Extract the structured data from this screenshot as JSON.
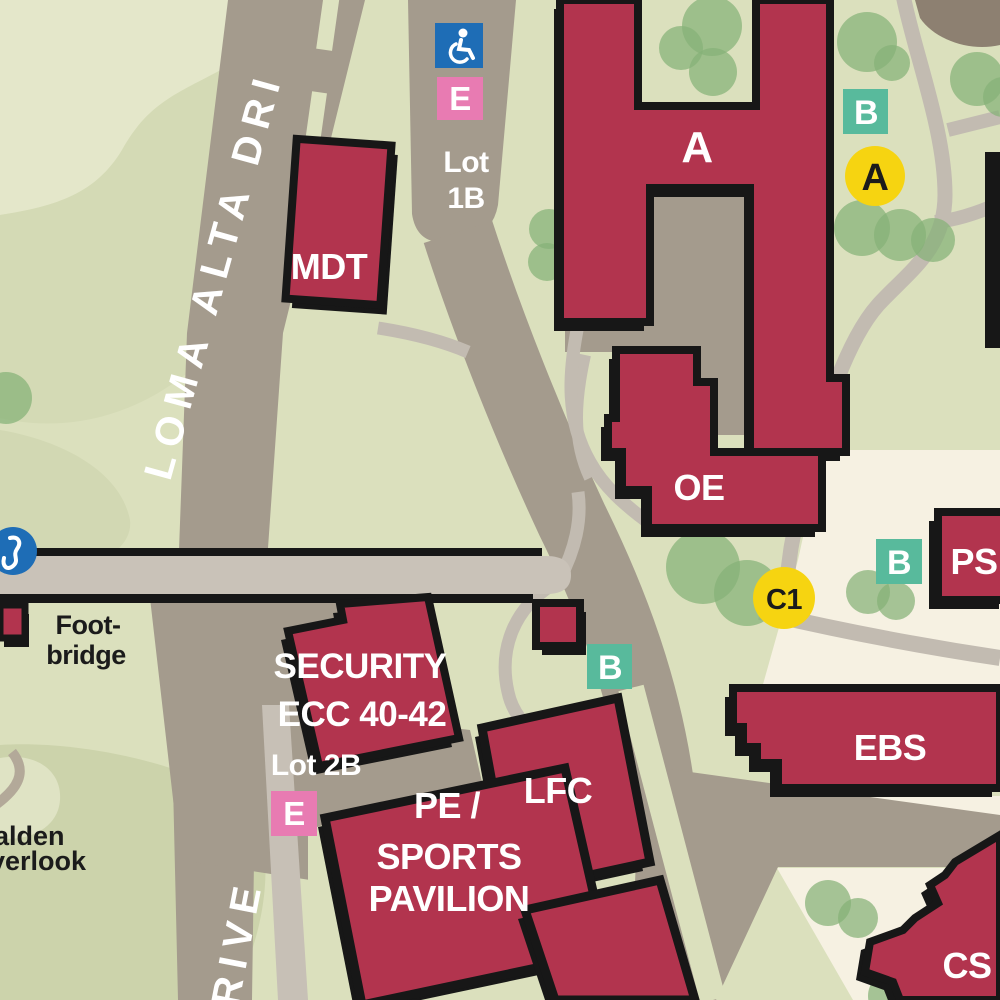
{
  "map": {
    "type": "campus-map",
    "roads": {
      "loma_alta_drive": "LOMA ALTA DRI",
      "drive_partial": "RIVE"
    },
    "parking": {
      "lot_1b": [
        "Lot",
        "1B"
      ],
      "lot_2b": "Lot 2B",
      "permit_label": "E"
    },
    "buildings": {
      "a": "A",
      "mdt": "MDT",
      "oe": "OE",
      "ps": "PS",
      "ebs": "EBS",
      "cs": "CS",
      "lfc": "LFC",
      "security": [
        "SECURITY",
        "ECC 40-42"
      ],
      "pavilion": [
        "PE /",
        "SPORTS",
        "PAVILION"
      ]
    },
    "stops": {
      "a": "A",
      "b": "B",
      "c1": "C1"
    },
    "annotations": {
      "footbridge": [
        "Foot-",
        "bridge"
      ],
      "overlook": [
        "alden",
        "verlook"
      ]
    },
    "icons": {
      "accessible_parking": "wheelchair-icon",
      "west_marker": "poi-icon"
    },
    "colors": {
      "background": "#dbe0bd",
      "background_light": "#e4e7ca",
      "background_sage": "#ccd3ab",
      "cream": "#f6f1e2",
      "road": "#a49b8d",
      "path": "#c2bbb1",
      "bridge": "#c9c2b8",
      "building": "#b2344e",
      "outline": "#171717",
      "tree": "#85b277",
      "stop_yellow": "#f6d411",
      "stop_teal": "#58ba9c",
      "permit_pink": "#e87bb2",
      "accessible_blue": "#1e6db6",
      "dirt": "#8d8071"
    }
  }
}
